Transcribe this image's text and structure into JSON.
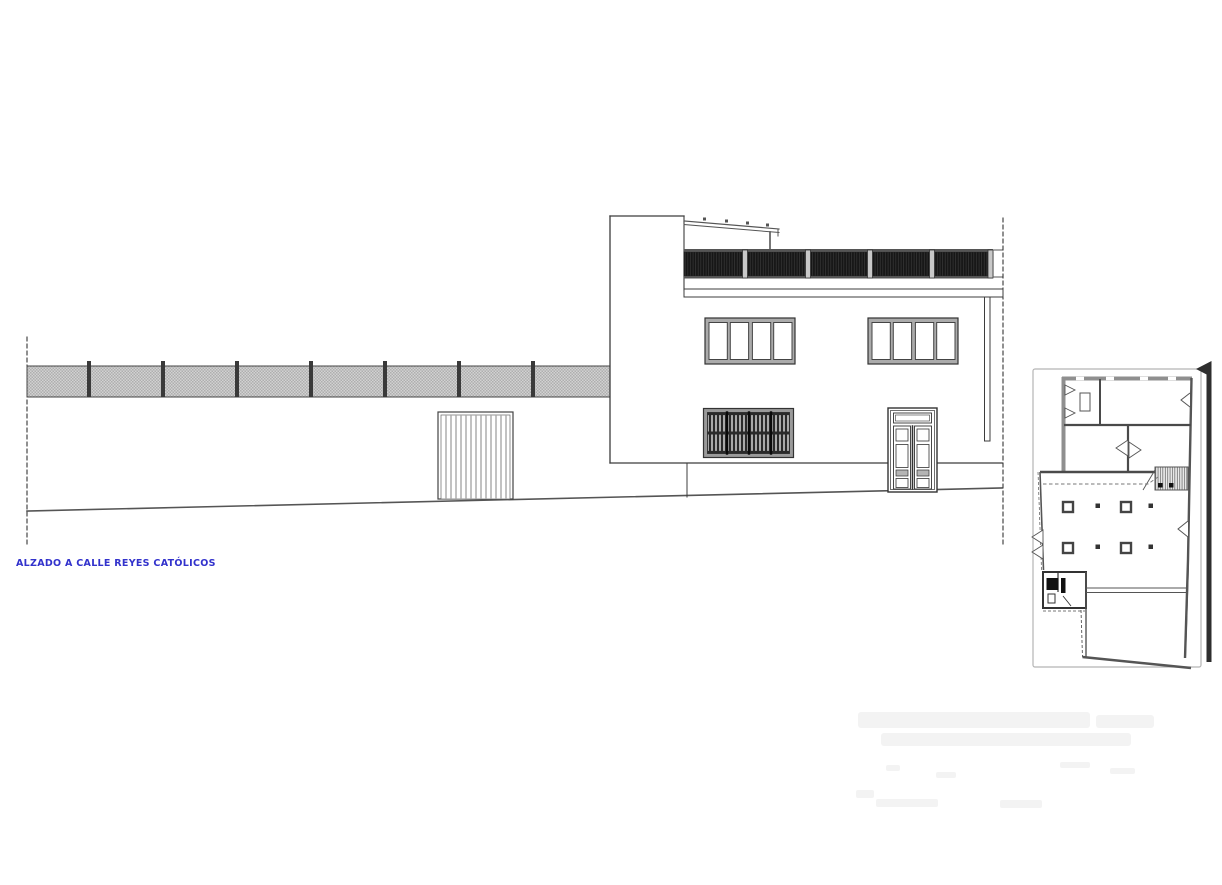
{
  "elevation": {
    "title": "ALZADO A CALLE REYES CATÓLICOS"
  },
  "colors": {
    "accent-blue": "#3232cc",
    "line-dark": "#3c3c3c",
    "fence-gray": "#c6c6c6",
    "railing-dark": "#181818",
    "frame-gray": "#9a9a9a",
    "paper": "#ffffff"
  }
}
